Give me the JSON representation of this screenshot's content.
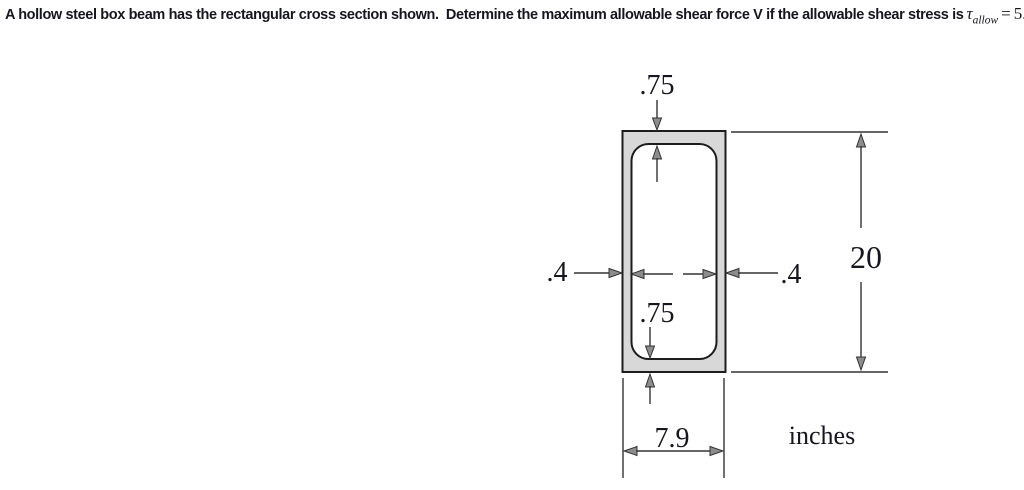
{
  "colors": {
    "background": "#ffffff",
    "box_fill": "#d8d8d8",
    "edge": "#1c1c1c",
    "line": "#333333",
    "arrow_fill": "#8c8c8c",
    "text": "#16161f"
  },
  "title": {
    "text": "A hollow steel box beam has the rectangular cross section shown.  Determine the maximum allowable shear force V if the allowable shear stress is",
    "tau": "τ",
    "tau_sub": "allow",
    "equals": "=",
    "value": "5.25",
    "unit": "ksi"
  },
  "figure": {
    "labels": {
      "top_wall_thickness": ".75",
      "bottom_wall_thickness": ".75",
      "left_wall_thickness": ".4",
      "right_wall_thickness": ".4",
      "overall_height": "20",
      "overall_width": "7.9",
      "units": "inches"
    }
  }
}
